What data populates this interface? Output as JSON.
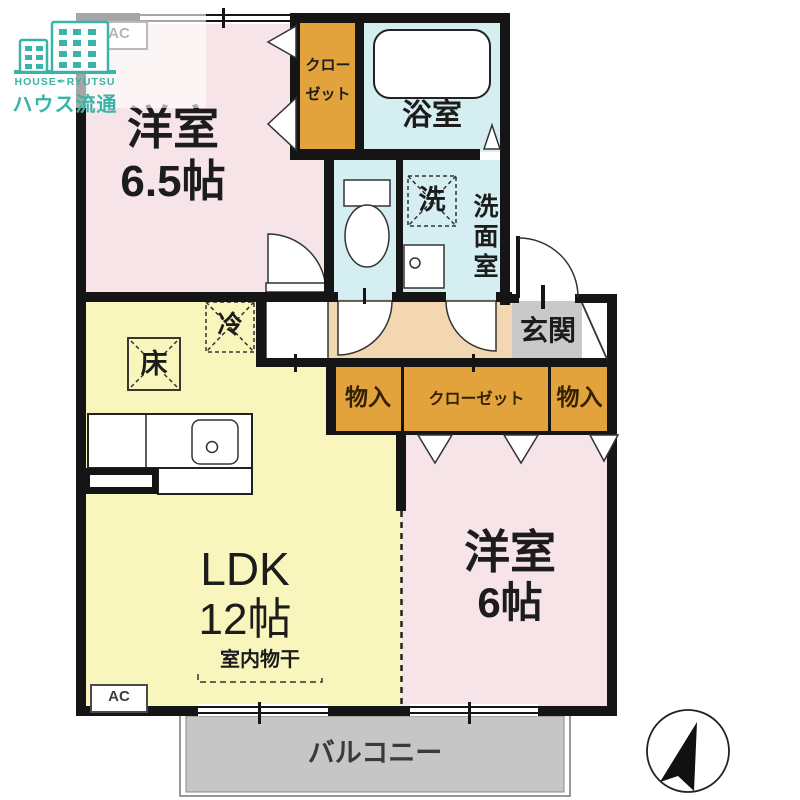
{
  "logo": {
    "en_left": "HOUSE",
    "separator_glyph": "✒",
    "en_right": "RYUTSU",
    "jp": "ハウス流通"
  },
  "plan": {
    "bedroom1": {
      "label": "洋室",
      "size": "6.5帖"
    },
    "closet_top": {
      "label": "クローゼット"
    },
    "bath": {
      "label": "浴室"
    },
    "washer": {
      "label": "洗"
    },
    "washroom": {
      "label": "洗面室"
    },
    "entrance": {
      "label": "玄関"
    },
    "fridge": {
      "label": "冷"
    },
    "floor_hatch": {
      "label": "床"
    },
    "ldk": {
      "label": "LDK",
      "size": "12帖",
      "drying": "室内物干"
    },
    "ac_top": {
      "label": "AC"
    },
    "ac_bottom": {
      "label": "AC"
    },
    "storage_left": {
      "label": "物入"
    },
    "closet_mid": {
      "label": "クローゼット"
    },
    "storage_right": {
      "label": "物入"
    },
    "bedroom2": {
      "label": "洋室",
      "size": "6帖"
    },
    "balcony": {
      "label": "バルコニー"
    }
  },
  "colors": {
    "wall": "#151515",
    "pink": "#f7e4e8",
    "yellow": "#f9f6bd",
    "orange": "#e2a23c",
    "blue": "#d4eef2",
    "tan": "#f3d6b2",
    "gray": "#c9c9c9",
    "balcony": "#c6c6c6",
    "teal": "#3ab3a8"
  }
}
